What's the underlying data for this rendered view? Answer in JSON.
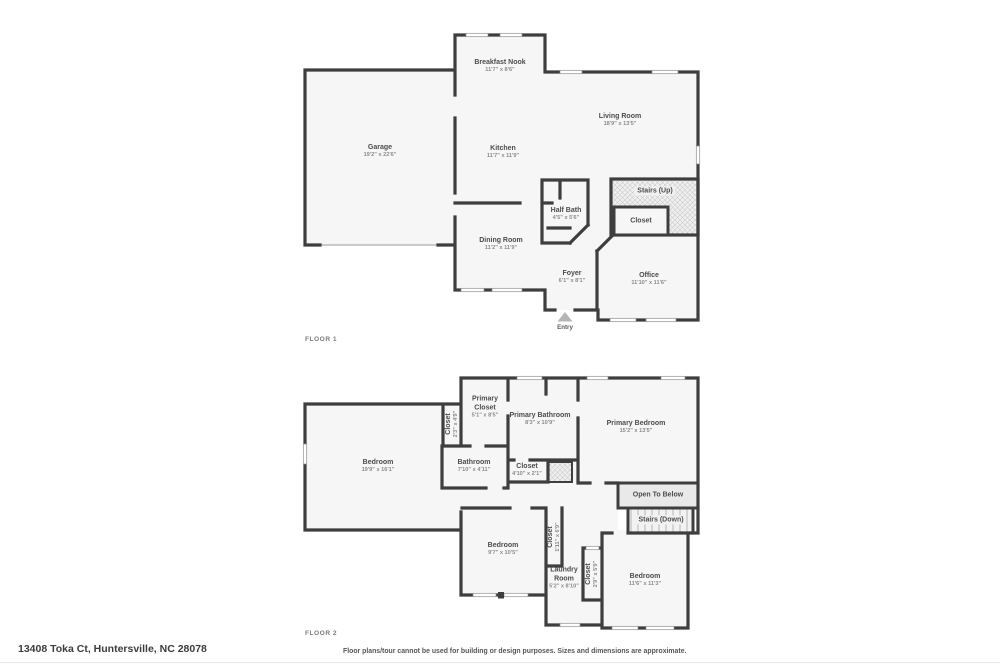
{
  "footer": {
    "address": "13408 Toka Ct, Huntersville, NC 28078",
    "disclaimer": "Floor plans/tour cannot be used for building or design purposes. Sizes and dimensions are approximate."
  },
  "floor1": {
    "label": "FLOOR 1",
    "rooms": [
      {
        "name": "Garage",
        "dims": "19'2\" x 22'6\""
      },
      {
        "name": "Breakfast Nook",
        "dims": "11'7\" x 8'6\""
      },
      {
        "name": "Kitchen",
        "dims": "11'7\" x 11'9\""
      },
      {
        "name": "Living Room",
        "dims": "18'9\" x 13'5\""
      },
      {
        "name": "Half Bath",
        "dims": "4'5\" x 5'6\""
      },
      {
        "name": "Stairs (Up)",
        "dims": ""
      },
      {
        "name": "Closet",
        "dims": ""
      },
      {
        "name": "Dining Room",
        "dims": "11'2\" x 11'9\""
      },
      {
        "name": "Foyer",
        "dims": "6'1\" x 8'1\""
      },
      {
        "name": "Office",
        "dims": "11'10\" x 11'6\""
      },
      {
        "name": "Entry",
        "dims": ""
      }
    ]
  },
  "floor2": {
    "label": "FLOOR 2",
    "rooms": [
      {
        "name": "Bedroom",
        "dims": "19'9\" x 16'1\""
      },
      {
        "name": "Closet",
        "dims": "2'3\" x 4'9\""
      },
      {
        "name": "Primary Closet",
        "dims": "5'1\" x 8'5\""
      },
      {
        "name": "Primary Bathroom",
        "dims": "8'3\" x 10'9\""
      },
      {
        "name": "Primary Bedroom",
        "dims": "15'2\" x 13'5\""
      },
      {
        "name": "Bathroom",
        "dims": "7'10\" x 4'11\""
      },
      {
        "name": "Closet",
        "dims": "4'10\" x 2'1\""
      },
      {
        "name": "Open To Below",
        "dims": ""
      },
      {
        "name": "Stairs (Down)",
        "dims": ""
      },
      {
        "name": "Bedroom",
        "dims": "9'7\" x 10'5\""
      },
      {
        "name": "Closet",
        "dims": "1'11\" x 6'9\""
      },
      {
        "name": "Laundry Room",
        "dims": "5'2\" x 8'10\""
      },
      {
        "name": "Closet",
        "dims": "2'9\" x 5'9\""
      },
      {
        "name": "Bedroom",
        "dims": "11'6\" x 11'3\""
      }
    ]
  }
}
